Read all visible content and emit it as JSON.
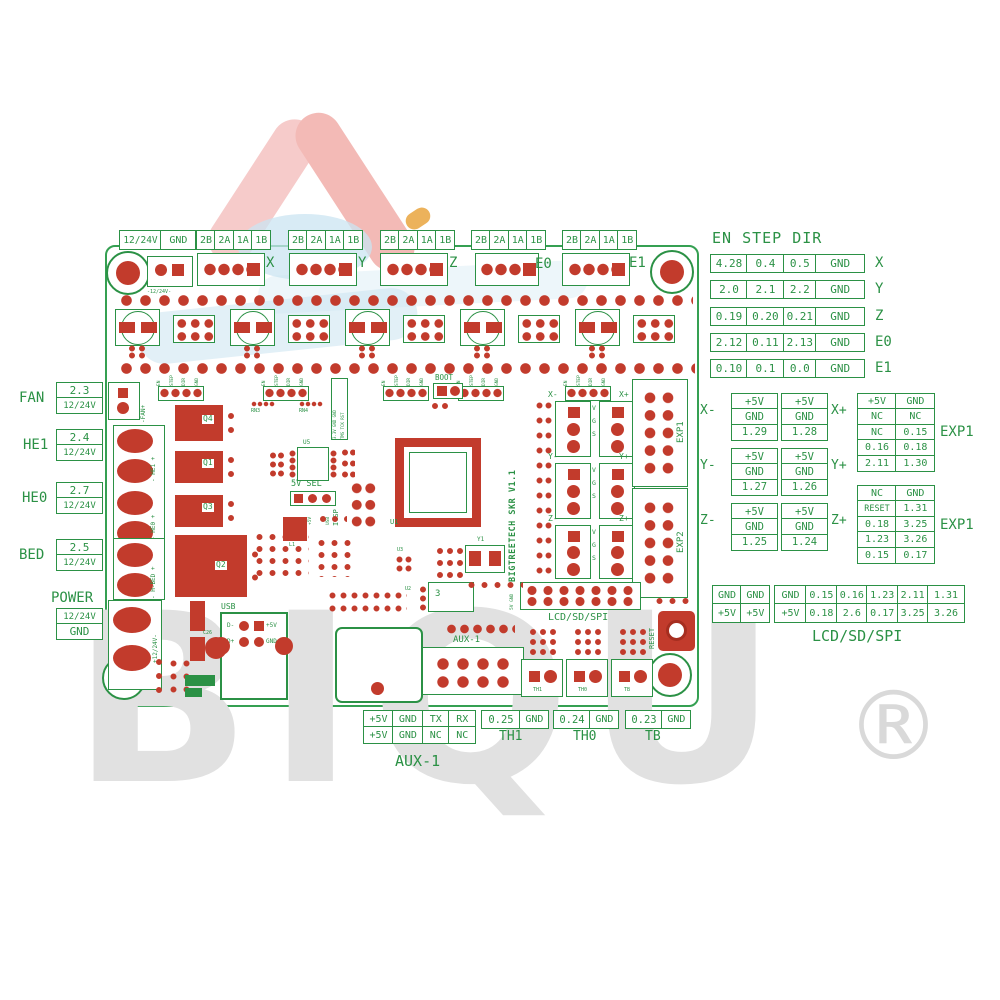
{
  "watermark": {
    "text": "BIQU",
    "registered": "®"
  },
  "colors": {
    "green": "#2b9145",
    "red": "#c23b2c",
    "logo_pink": "#f5c6c3",
    "logo_blue": "#cbe4f1",
    "watermark_gray": "#e1e1e1"
  },
  "top": {
    "power": [
      "12/24V",
      "GND"
    ],
    "motors": [
      {
        "pins": [
          "2B",
          "2A",
          "1A",
          "1B"
        ],
        "axis": "X"
      },
      {
        "pins": [
          "2B",
          "2A",
          "1A",
          "1B"
        ],
        "axis": "Y"
      },
      {
        "pins": [
          "2B",
          "2A",
          "1A",
          "1B"
        ],
        "axis": "Z"
      },
      {
        "pins": [
          "2B",
          "2A",
          "1A",
          "1B"
        ],
        "axis": "E0"
      },
      {
        "pins": [
          "2B",
          "2A",
          "1A",
          "1B"
        ],
        "axis": "E1"
      }
    ]
  },
  "en_step_dir": {
    "title": "EN STEP DIR",
    "rows": [
      {
        "cells": [
          "4.28",
          "0.4",
          "0.5",
          "GND"
        ],
        "axis": "X"
      },
      {
        "cells": [
          "2.0",
          "2.1",
          "2.2",
          "GND"
        ],
        "axis": "Y"
      },
      {
        "cells": [
          "0.19",
          "0.20",
          "0.21",
          "GND"
        ],
        "axis": "Z"
      },
      {
        "cells": [
          "2.12",
          "0.11",
          "2.13",
          "GND"
        ],
        "axis": "E0"
      },
      {
        "cells": [
          "0.10",
          "0.1",
          "0.0",
          "GND"
        ],
        "axis": "E1"
      }
    ]
  },
  "endstops": [
    {
      "neg_label": "X-",
      "neg": [
        "+5V",
        "GND",
        "1.29"
      ],
      "pos": [
        "+5V",
        "GND",
        "1.28"
      ],
      "pos_label": "X+"
    },
    {
      "neg_label": "Y-",
      "neg": [
        "+5V",
        "GND",
        "1.27"
      ],
      "pos": [
        "+5V",
        "GND",
        "1.26"
      ],
      "pos_label": "Y+"
    },
    {
      "neg_label": "Z-",
      "neg": [
        "+5V",
        "GND",
        "1.25"
      ],
      "pos": [
        "+5V",
        "GND",
        "1.24"
      ],
      "pos_label": "Z+"
    }
  ],
  "exp": [
    {
      "label": "EXP1",
      "rows": [
        [
          "+5V",
          "GND"
        ],
        [
          "NC",
          "NC"
        ],
        [
          "NC",
          "0.15"
        ],
        [
          "0.16",
          "0.18"
        ],
        [
          "2.11",
          "1.30"
        ]
      ]
    },
    {
      "label": "EXP1",
      "rows": [
        [
          "NC",
          "GND"
        ],
        [
          "RESET",
          "1.31"
        ],
        [
          "0.18",
          "3.25"
        ],
        [
          "1.23",
          "3.26"
        ],
        [
          "0.15",
          "0.17"
        ]
      ]
    }
  ],
  "lcd": {
    "power_pairs": [
      [
        "GND",
        "GND"
      ],
      [
        "+5V",
        "+5V"
      ]
    ],
    "main": [
      [
        "GND",
        "0.15",
        "0.16",
        "1.23",
        "2.11",
        "1.31"
      ],
      [
        "+5V",
        "0.18",
        "2.6",
        "0.17",
        "3.25",
        "3.26"
      ]
    ],
    "label": "LCD/SD/SPI"
  },
  "left": [
    {
      "name": "FAN",
      "pin": "2.3",
      "voltage": "12/24V"
    },
    {
      "name": "HE1",
      "pin": "2.4",
      "voltage": "12/24V"
    },
    {
      "name": "HE0",
      "pin": "2.7",
      "voltage": "12/24V"
    },
    {
      "name": "BED",
      "pin": "2.5",
      "voltage": "12/24V"
    },
    {
      "name": "POWER",
      "pin": "12/24V",
      "voltage": "GND"
    }
  ],
  "aux1": {
    "label": "AUX-1",
    "rows": [
      [
        "+5V",
        "GND",
        "TX",
        "RX"
      ],
      [
        "+5V",
        "GND",
        "NC",
        "NC"
      ]
    ]
  },
  "thermistors": [
    {
      "pin": "0.25",
      "gnd": "GND",
      "name": "TH1"
    },
    {
      "pin": "0.24",
      "gnd": "GND",
      "name": "TH0"
    },
    {
      "pin": "0.23",
      "gnd": "GND",
      "name": "TB"
    }
  ],
  "board": {
    "title": "BIGTREETECH SKR V1.1",
    "power_conn_label": "-12/24V-",
    "driver_pins": [
      "EN",
      "STEP",
      "DIR",
      "GND"
    ],
    "mcu": "U1",
    "boot": "BOOT",
    "sel_title": "5V SEL",
    "sel_options": [
      "INT",
      "+5V",
      "USB"
    ],
    "icsp": "ICSP",
    "icsp_pins_left": "3.3V GND GND",
    "icsp_pins_right": "TMS TCK RST",
    "usb": {
      "label": "USB",
      "pins": [
        "D-",
        "+5V",
        "D+",
        "GND"
      ]
    },
    "mosfets": [
      "Q4",
      "Q1",
      "Q3",
      "Q2"
    ],
    "fan_label": "-FAN+",
    "he1_label": "- HE1 +",
    "he0_label": "- HE0 +",
    "bed_label": "- H-BED +",
    "power_in_label": "+12/24V-",
    "endstop_labels": [
      "X-",
      "X+",
      "Y-",
      "Y+",
      "Z-",
      "Z+"
    ],
    "endstop_pins": [
      "V",
      "G",
      "S"
    ],
    "exp1": "EXP1",
    "exp2": "EXP2",
    "tft": "TFT",
    "aux1": "AUX-1",
    "lcd_header": "LCD/SD/SPI",
    "lcd_side": "5V GND",
    "reset": "RESET",
    "th_labels": [
      "TH1",
      "TH0",
      "TB"
    ],
    "misc": {
      "rn3": "RN3",
      "rn4": "RN4",
      "u5": "U5",
      "u3": "U3",
      "u2": "U2",
      "y1": "Y1",
      "l1": "L1",
      "c26": "C26",
      "reg": "3"
    }
  }
}
